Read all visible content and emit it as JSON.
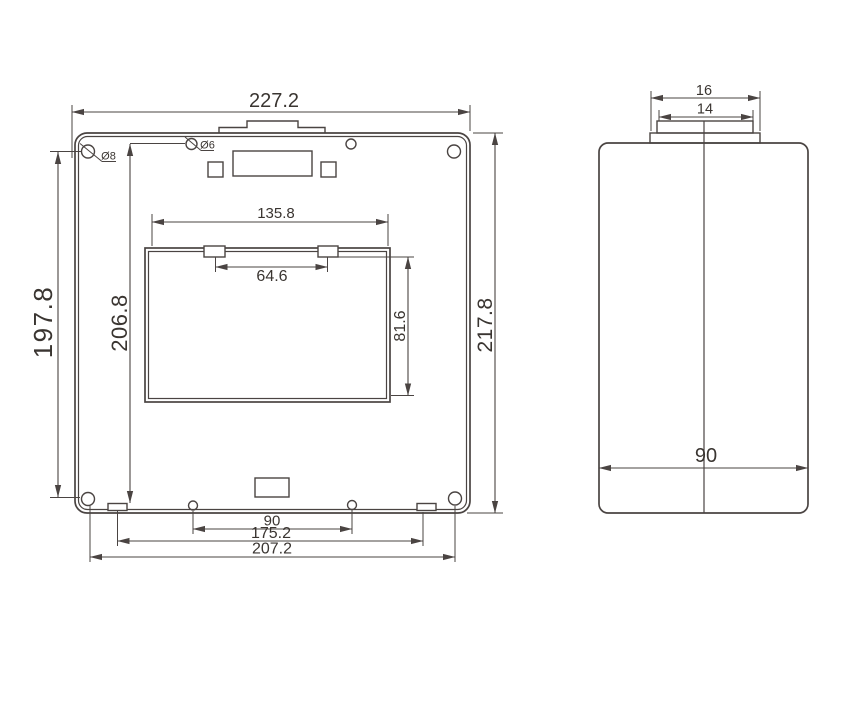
{
  "drawing": {
    "colors": {
      "line": "#4a4442",
      "text": "#3a3531",
      "background": "#ffffff"
    },
    "front_view": {
      "dims": {
        "overall_width": "227.2",
        "left_height": "197.8",
        "inner_height": "206.8",
        "right_height": "217.8",
        "window_width": "135.8",
        "clip_spacing": "64.6",
        "window_height": "81.6",
        "bottom_hole_spacing": "90",
        "bottom_tab_spacing": "175.2",
        "corner_hole_spacing": "207.2"
      },
      "hole_labels": {
        "corner_hole_dia": "Ø8",
        "top_hole_dia": "Ø6"
      }
    },
    "side_view": {
      "dims": {
        "cap_outer_width": "16",
        "cap_inner_width": "14",
        "body_depth": "90"
      }
    }
  }
}
